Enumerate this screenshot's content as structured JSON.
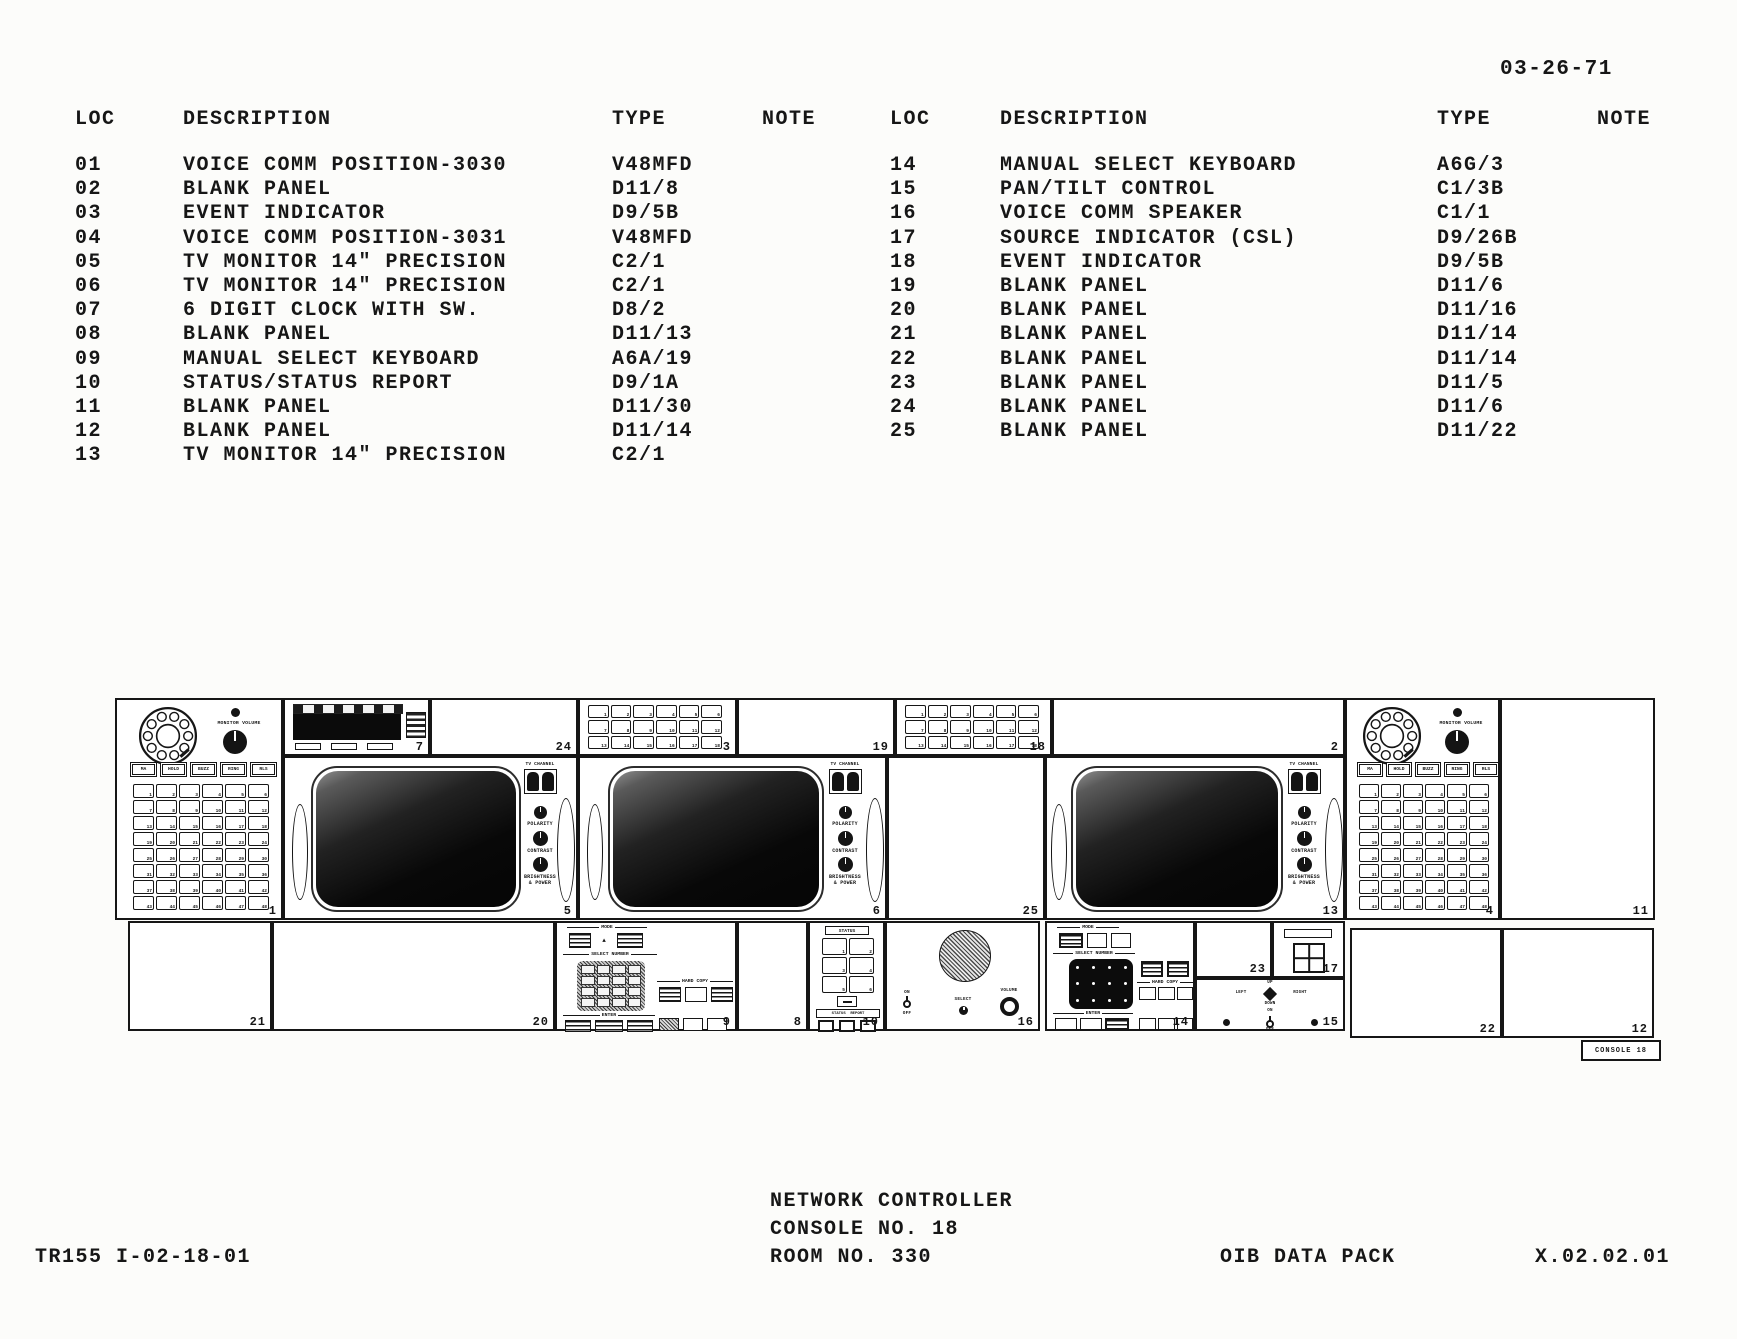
{
  "page": {
    "date": "03-26-71"
  },
  "equipment_table": {
    "headers": {
      "loc": "LOC",
      "description": "DESCRIPTION",
      "type": "TYPE",
      "note": "NOTE"
    },
    "left_rows": [
      {
        "loc": "01",
        "description": "VOICE COMM POSITION-3030",
        "type": "V48MFD"
      },
      {
        "loc": "02",
        "description": "BLANK PANEL",
        "type": "D11/8"
      },
      {
        "loc": "03",
        "description": "EVENT INDICATOR",
        "type": "D9/5B"
      },
      {
        "loc": "04",
        "description": "VOICE COMM POSITION-3031",
        "type": "V48MFD"
      },
      {
        "loc": "05",
        "description": "TV MONITOR 14\" PRECISION",
        "type": "C2/1"
      },
      {
        "loc": "06",
        "description": "TV MONITOR 14\" PRECISION",
        "type": "C2/1"
      },
      {
        "loc": "07",
        "description": "6 DIGIT CLOCK WITH SW.",
        "type": "D8/2"
      },
      {
        "loc": "08",
        "description": "BLANK PANEL",
        "type": "D11/13"
      },
      {
        "loc": "09",
        "description": "MANUAL SELECT KEYBOARD",
        "type": "A6A/19"
      },
      {
        "loc": "10",
        "description": "STATUS/STATUS REPORT",
        "type": "D9/1A"
      },
      {
        "loc": "11",
        "description": "BLANK PANEL",
        "type": "D11/30"
      },
      {
        "loc": "12",
        "description": "BLANK PANEL",
        "type": "D11/14"
      },
      {
        "loc": "13",
        "description": "TV MONITOR 14\" PRECISION",
        "type": "C2/1"
      }
    ],
    "right_rows": [
      {
        "loc": "14",
        "description": "MANUAL SELECT KEYBOARD",
        "type": "A6G/3"
      },
      {
        "loc": "15",
        "description": "PAN/TILT CONTROL",
        "type": "C1/3B"
      },
      {
        "loc": "16",
        "description": "VOICE COMM SPEAKER",
        "type": "C1/1"
      },
      {
        "loc": "17",
        "description": "SOURCE INDICATOR (CSL)",
        "type": "D9/26B"
      },
      {
        "loc": "18",
        "description": "EVENT INDICATOR",
        "type": "D9/5B"
      },
      {
        "loc": "19",
        "description": "BLANK PANEL",
        "type": "D11/6"
      },
      {
        "loc": "20",
        "description": "BLANK PANEL",
        "type": "D11/16"
      },
      {
        "loc": "21",
        "description": "BLANK PANEL",
        "type": "D11/14"
      },
      {
        "loc": "22",
        "description": "BLANK PANEL",
        "type": "D11/14"
      },
      {
        "loc": "23",
        "description": "BLANK PANEL",
        "type": "D11/5"
      },
      {
        "loc": "24",
        "description": "BLANK PANEL",
        "type": "D11/6"
      },
      {
        "loc": "25",
        "description": "BLANK PANEL",
        "type": "D11/22"
      }
    ]
  },
  "diagram": {
    "panels": {
      "n1": "1",
      "n2": "2",
      "n3": "3",
      "n4": "4",
      "n5": "5",
      "n6": "6",
      "n7": "7",
      "n8": "8",
      "n9": "9",
      "n10": "10",
      "n11": "11",
      "n12": "12",
      "n13": "13",
      "n14": "14",
      "n15": "15",
      "n16": "16",
      "n17": "17",
      "n18": "18",
      "n19": "19",
      "n20": "20",
      "n21": "21",
      "n22": "22",
      "n23": "23",
      "n24": "24",
      "n25": "25"
    },
    "labels": {
      "monitor_volume": "MONITOR VOLUME",
      "tv_channel": "TV CHANNEL",
      "polarity": "POLARITY",
      "contrast": "CONTRAST",
      "brightness_power": "BRIGHTNESS & POWER",
      "mode": "MODE",
      "select_number": "SELECT NUMBER",
      "hard_copy": "HARD COPY",
      "enter": "ENTER",
      "status": "STATUS",
      "status_report": "STATUS  REPORT",
      "on": "ON",
      "off": "OFF",
      "select": "SELECT",
      "volume": "VOLUME",
      "up": "UP",
      "down": "DOWN",
      "left": "LEFT",
      "right": "RIGHT",
      "mode_arrow": "▲"
    },
    "comm_buttons": [
      "MA",
      "HOLD",
      "BUZZ",
      "RING",
      "RLS"
    ],
    "console_tag": "CONSOLE 18"
  },
  "footer": {
    "drawing_number": "TR155 I-02-18-01",
    "title_line1": "NETWORK CONTROLLER",
    "title_line2": "CONSOLE NO. 18",
    "title_line3": "ROOM NO. 330",
    "data_pack": "OIB DATA PACK",
    "sheet_number": "X.02.02.01"
  }
}
